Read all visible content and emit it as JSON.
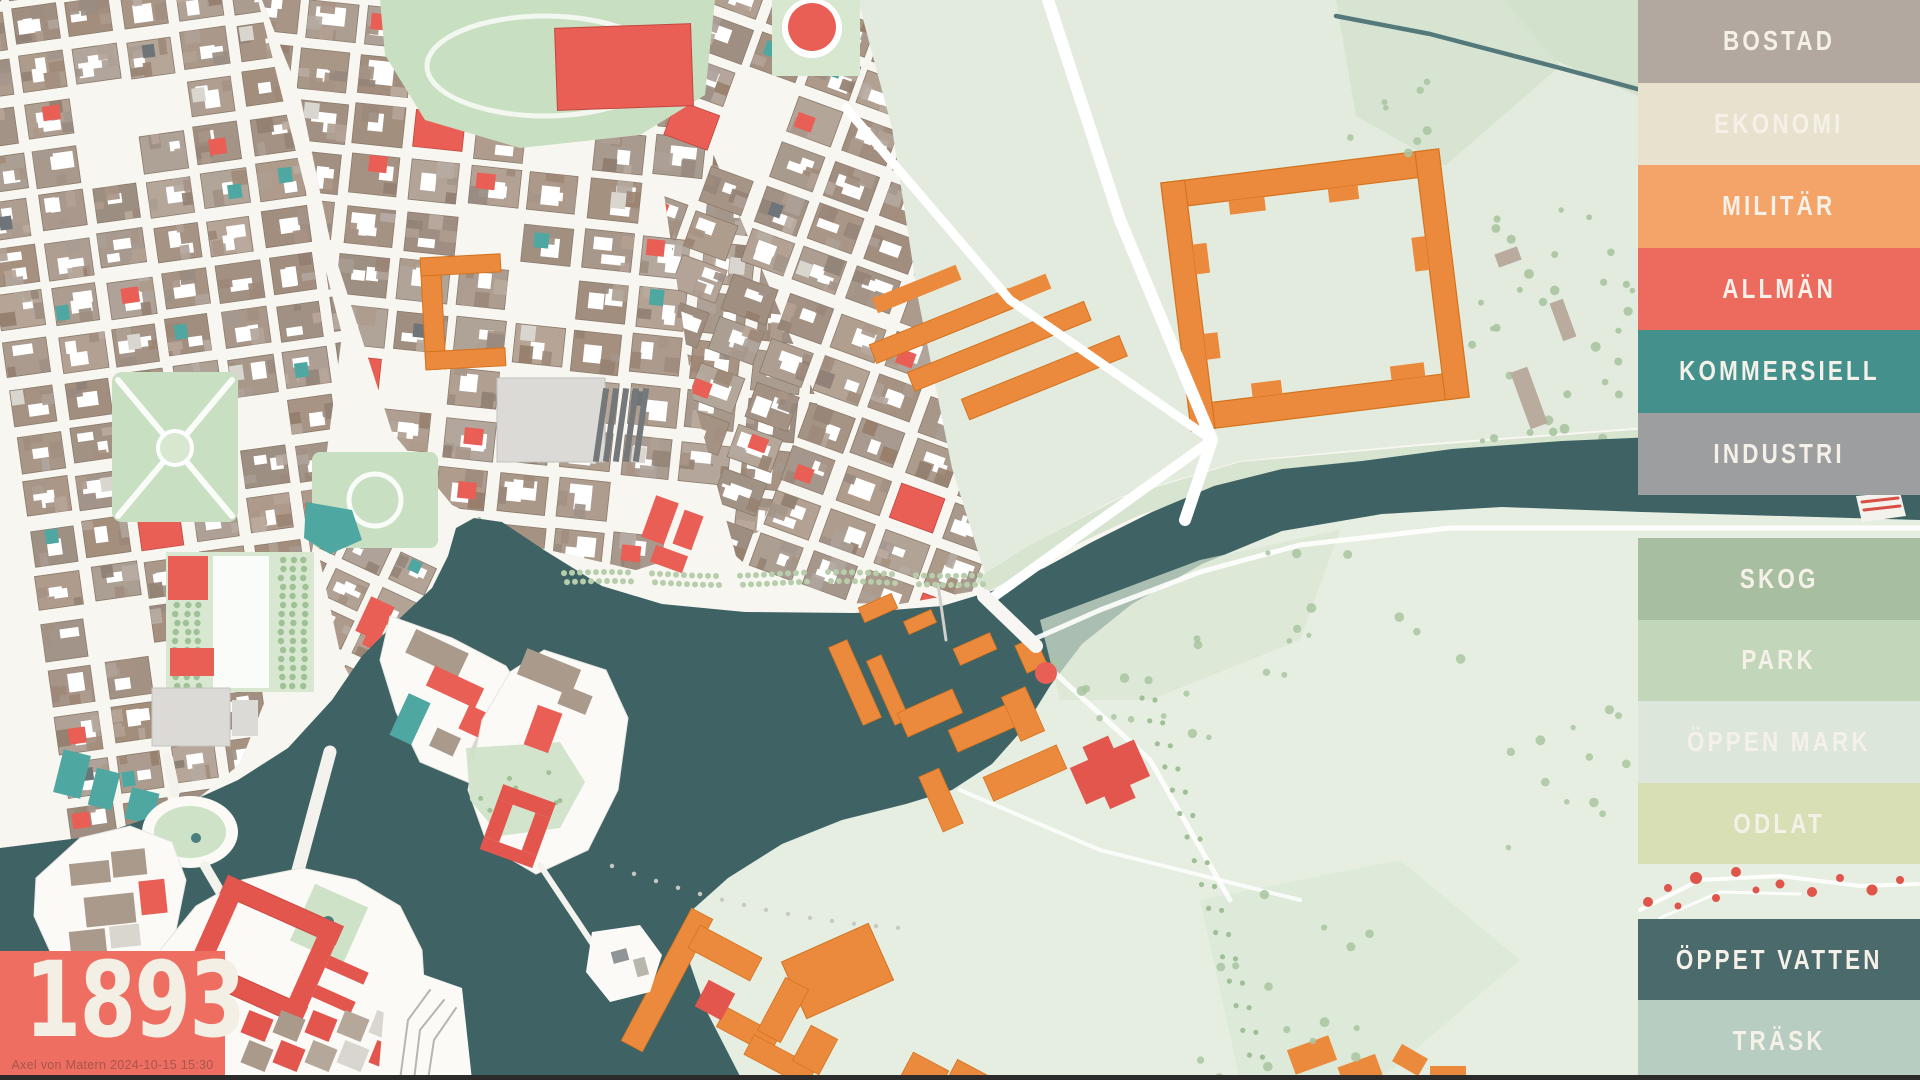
{
  "map": {
    "year": "1893",
    "credit": "Axel von Matern 2024-10-15 15:30"
  },
  "year_box": {
    "background": "#ee6f61",
    "year_color": "#f4efe5",
    "credit_color": "#a8554c"
  },
  "legend": {
    "text_color": "#f5f1e8",
    "building_categories": [
      {
        "label": "BOSTAD",
        "color": "#b2a89f"
      },
      {
        "label": "EKONOMI",
        "color": "#e7e1cd"
      },
      {
        "label": "MILITÄR",
        "color": "#f4a469"
      },
      {
        "label": "ALLMÄN",
        "color": "#ed6a5e"
      },
      {
        "label": "KOMMERSIELL",
        "color": "#43908d"
      },
      {
        "label": "INDUSTRI",
        "color": "#9c9ea0"
      }
    ],
    "landscape_categories": [
      {
        "label": "SKOG",
        "color": "#a7bfa0"
      },
      {
        "label": "PARK",
        "color": "#c2d6ba"
      },
      {
        "label": "ÖPPEN MARK",
        "color": "#dde6da"
      },
      {
        "label": "ODLAT",
        "color": "#d8dfb4"
      }
    ],
    "water_categories": [
      {
        "label": "ÖPPET VATTEN",
        "color": "#4a6a6b"
      },
      {
        "label": "TRÄSK",
        "color": "#b7cdc1"
      }
    ]
  },
  "map_colors": {
    "land": "#f8f6f1",
    "street": "#ffffff",
    "water": "#3f6364",
    "block": "#a99a8b",
    "accent_red": "#e95f55",
    "accent_teal": "#4fa7a1",
    "accent_dark_gray": "#6e7478",
    "accent_light_gray": "#d9d5cf",
    "park": "#c9dfc1",
    "park_formal": "#d8e7d0",
    "field": "#e3ebdf",
    "field_dark": "#cfe0ca",
    "djurgarden": "#e6eee1",
    "tree": "#a9c5a0",
    "orange": "#eb8a3c",
    "orange_stroke": "#d4731e",
    "red_building": "#e2564e",
    "gray_building": "#74787b",
    "pale_gray": "#dbdad6",
    "stream": "#54797a",
    "bottom_bar": "#2b2b2b"
  }
}
